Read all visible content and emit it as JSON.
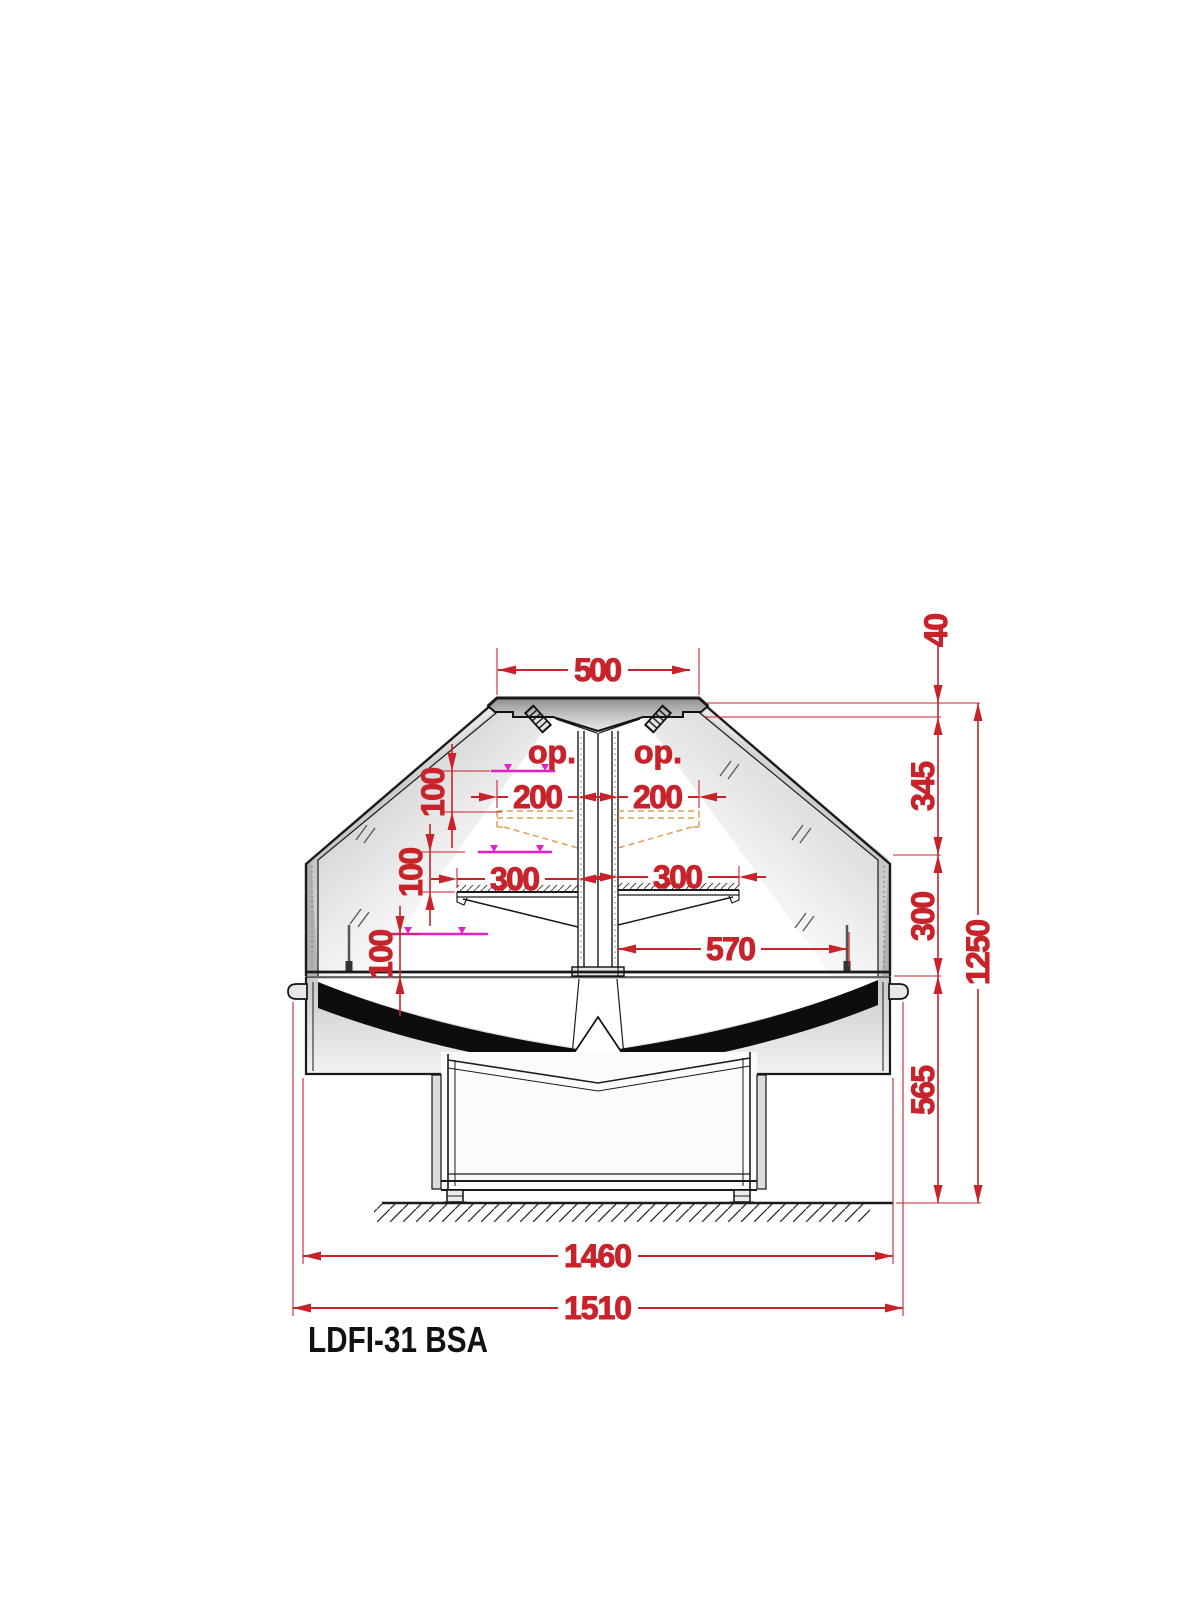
{
  "drawing": {
    "title": "LDFI-31 BSA",
    "labels": {
      "optional_left": "op.",
      "optional_right": "op."
    },
    "dimensions": {
      "top_width": "500",
      "cap_thickness": "40",
      "glass_section_height": "345",
      "mid_section_height": "300",
      "base_section_height": "565",
      "total_height": "1250",
      "upper_shelf_depth_left": "200",
      "upper_shelf_depth_right": "200",
      "shelf_depth_left": "300",
      "shelf_depth_right": "300",
      "counter_depth": "570",
      "rail_gap_upper": "100",
      "rail_gap_middle": "100",
      "rail_gap_lower": "100",
      "body_width": "1460",
      "overall_width": "1510"
    },
    "colors": {
      "dimension_red": "#c8232b",
      "price_rail_magenta": "#e61ec8",
      "optional_shelf_orange": "#dfa054",
      "outline_black": "#1a1a1a"
    }
  }
}
